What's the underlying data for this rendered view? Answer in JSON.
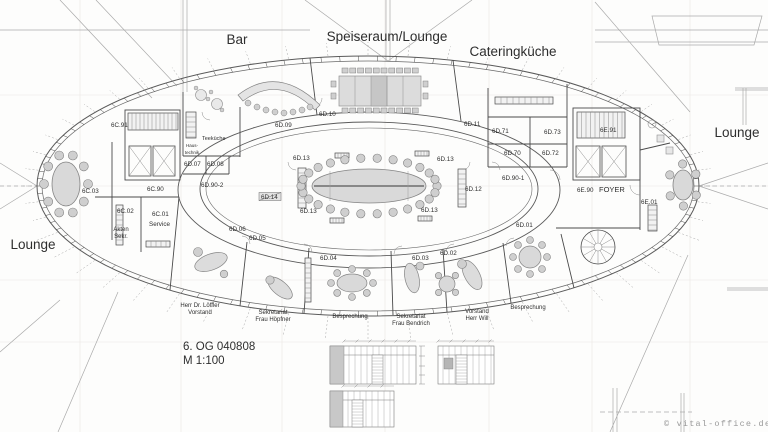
{
  "plan_meta": {
    "drawing_title": "6. OG 040808",
    "scale": "M 1:100"
  },
  "watermark": {
    "text": "© vital-office.de"
  },
  "colors": {
    "walls": "#4a4a4a",
    "thin_lines": "#8a8a8a",
    "construction": "#a8a8a8",
    "furniture_fill": "#dcdcdc",
    "furniture_stroke": "#848484",
    "chair_fill": "#cfcfcf",
    "text": "#2e2e2e",
    "watermark": "#9a9a9a"
  },
  "labels": {
    "areas": [
      {
        "text": "Bar",
        "x": 237,
        "y": 44
      },
      {
        "text": "Speiseraum/Lounge",
        "x": 387,
        "y": 41
      },
      {
        "text": "Cateringküche",
        "x": 513,
        "y": 56
      },
      {
        "text": "Lounge",
        "x": 737,
        "y": 137
      },
      {
        "text": "Lounge",
        "x": 33,
        "y": 249
      }
    ],
    "rooms": [
      {
        "text": "6D.10",
        "x": 319,
        "y": 116
      },
      {
        "text": "6D.09",
        "x": 275,
        "y": 127
      },
      {
        "text": "6D.11",
        "x": 464,
        "y": 126
      },
      {
        "text": "6D.71",
        "x": 492,
        "y": 133
      },
      {
        "text": "6D.73",
        "x": 544,
        "y": 134
      },
      {
        "text": "6D.70",
        "x": 504,
        "y": 155
      },
      {
        "text": "6D.72",
        "x": 542,
        "y": 155
      },
      {
        "text": "6E.91",
        "x": 600,
        "y": 132
      },
      {
        "text": "6C.91",
        "x": 111,
        "y": 127
      },
      {
        "text": "Teeküche",
        "x": 202,
        "y": 140,
        "size": 5.5
      },
      {
        "text": "6D.07",
        "x": 184,
        "y": 166
      },
      {
        "text": "6D.08",
        "x": 207,
        "y": 166
      },
      {
        "text": "6C.03",
        "x": 82,
        "y": 193
      },
      {
        "text": "6C.90",
        "x": 147,
        "y": 191
      },
      {
        "text": "6D.90-2",
        "x": 201,
        "y": 187
      },
      {
        "text": "6D.90-1",
        "x": 502,
        "y": 180
      },
      {
        "text": "6D.13",
        "x": 293,
        "y": 160
      },
      {
        "text": "6D.13",
        "x": 437,
        "y": 161
      },
      {
        "text": "6D.13",
        "x": 300,
        "y": 213
      },
      {
        "text": "6D.13",
        "x": 421,
        "y": 212
      },
      {
        "text": "6D.14",
        "x": 261,
        "y": 199,
        "boxed": true
      },
      {
        "text": "6D.12",
        "x": 465,
        "y": 191
      },
      {
        "text": "6C.02",
        "x": 117,
        "y": 213
      },
      {
        "text": "6C.01",
        "x": 152,
        "y": 216
      },
      {
        "text": "Service",
        "x": 149,
        "y": 226
      },
      {
        "text": "6D.06",
        "x": 229,
        "y": 231
      },
      {
        "text": "6D.05",
        "x": 249,
        "y": 240
      },
      {
        "text": "6D.04",
        "x": 320,
        "y": 260
      },
      {
        "text": "6D.03",
        "x": 412,
        "y": 260
      },
      {
        "text": "6D.02",
        "x": 440,
        "y": 255
      },
      {
        "text": "6D.01",
        "x": 516,
        "y": 227
      },
      {
        "text": "6E.90",
        "x": 577,
        "y": 192
      },
      {
        "text": "FOYER",
        "x": 599,
        "y": 192,
        "size": 7.5
      },
      {
        "text": "6E.01",
        "x": 641,
        "y": 204
      }
    ],
    "names": [
      {
        "lines": [
          "Herr Dr. Löffler",
          "Vorstand"
        ],
        "x": 200,
        "y": 307
      },
      {
        "lines": [
          "Sekretariat",
          "Frau Höpfner"
        ],
        "x": 273,
        "y": 314
      },
      {
        "lines": [
          "Besprechung"
        ],
        "x": 350,
        "y": 318
      },
      {
        "lines": [
          "Sekretariat",
          "Frau Bendrich"
        ],
        "x": 411,
        "y": 318
      },
      {
        "lines": [
          "Vorstand",
          "Herr Will"
        ],
        "x": 477,
        "y": 313
      },
      {
        "lines": [
          "Besprechung"
        ],
        "x": 528,
        "y": 309
      },
      {
        "lines": [
          "Haus-",
          "technik"
        ],
        "x": 192,
        "y": 147,
        "size": 4.5
      },
      {
        "lines": [
          "Akten",
          "Sekr."
        ],
        "x": 121,
        "y": 231
      }
    ]
  }
}
